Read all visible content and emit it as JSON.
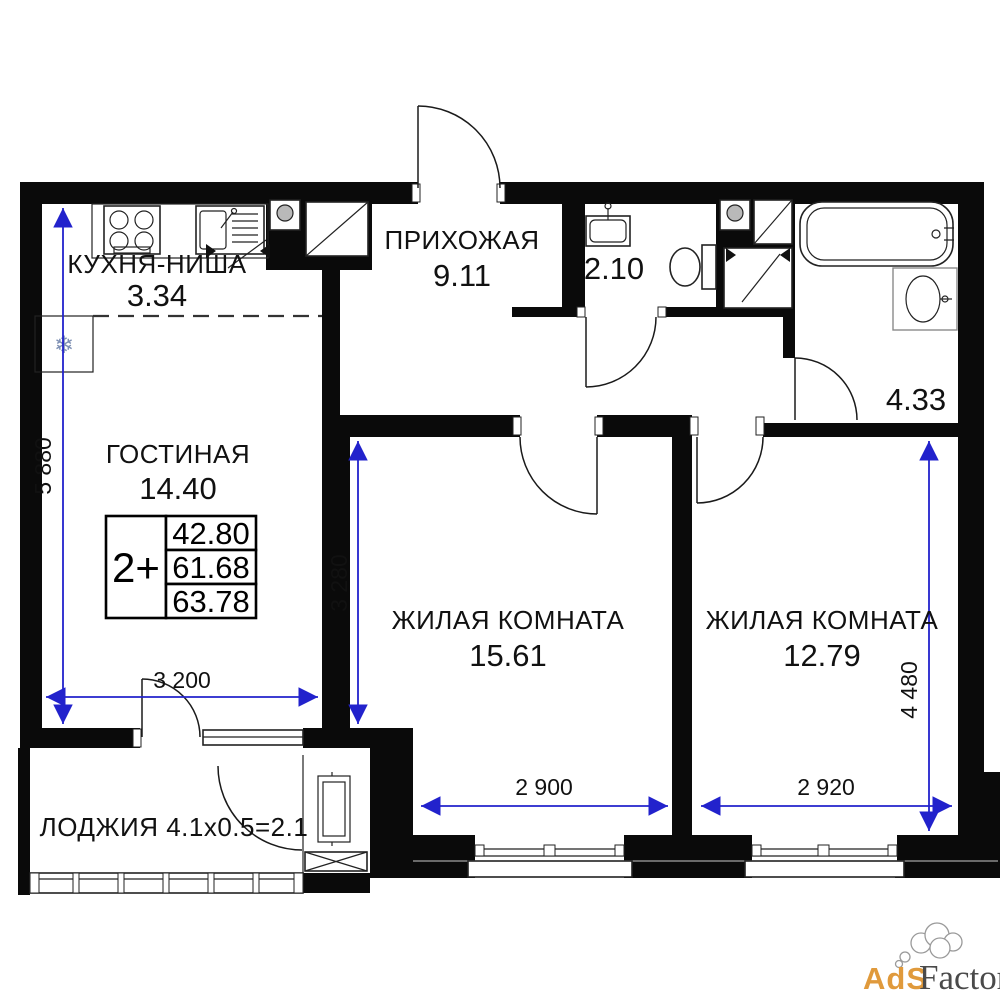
{
  "page": {
    "background": "#ffffff"
  },
  "colors": {
    "wall": "#0a0a0a",
    "dimension_blue": "#2222cc",
    "card_accent_yellow": "#fbde8c",
    "watermark_orange": "#e09a3c",
    "watermark_gray": "#4a4a4a"
  },
  "rooms": {
    "kitchen": {
      "name": "КУХНЯ-НИША",
      "area": "3.34"
    },
    "hallway": {
      "name": "ПРИХОЖАЯ",
      "area": "9.11"
    },
    "wc": {
      "area": "2.10"
    },
    "bathroom": {
      "area": "4.33"
    },
    "living": {
      "name": "ГОСТИНАЯ",
      "area": "14.40"
    },
    "bedroom1": {
      "name": "ЖИЛАЯ КОМНАТА",
      "area": "15.61"
    },
    "bedroom2": {
      "name": "ЖИЛАЯ КОМНАТА",
      "area": "12.79"
    },
    "loggia": {
      "label": "ЛОДЖИЯ 4.1x0.5=2.1"
    }
  },
  "apartment_card": {
    "type": "2+",
    "value1": "42.80",
    "value2": "61.68",
    "value3": "63.78",
    "accent_color": "#fbde8c"
  },
  "dimensions": {
    "left_height": "5 880",
    "living_width": "3 200",
    "living_depth": "3 280",
    "bedroom1_width": "2 900",
    "bedroom2_width": "2 920",
    "bedroom2_height": "4 480"
  },
  "icons": {
    "snowflake": "❄"
  },
  "watermark": {
    "part1": "AdS",
    "part2": "Factory"
  }
}
